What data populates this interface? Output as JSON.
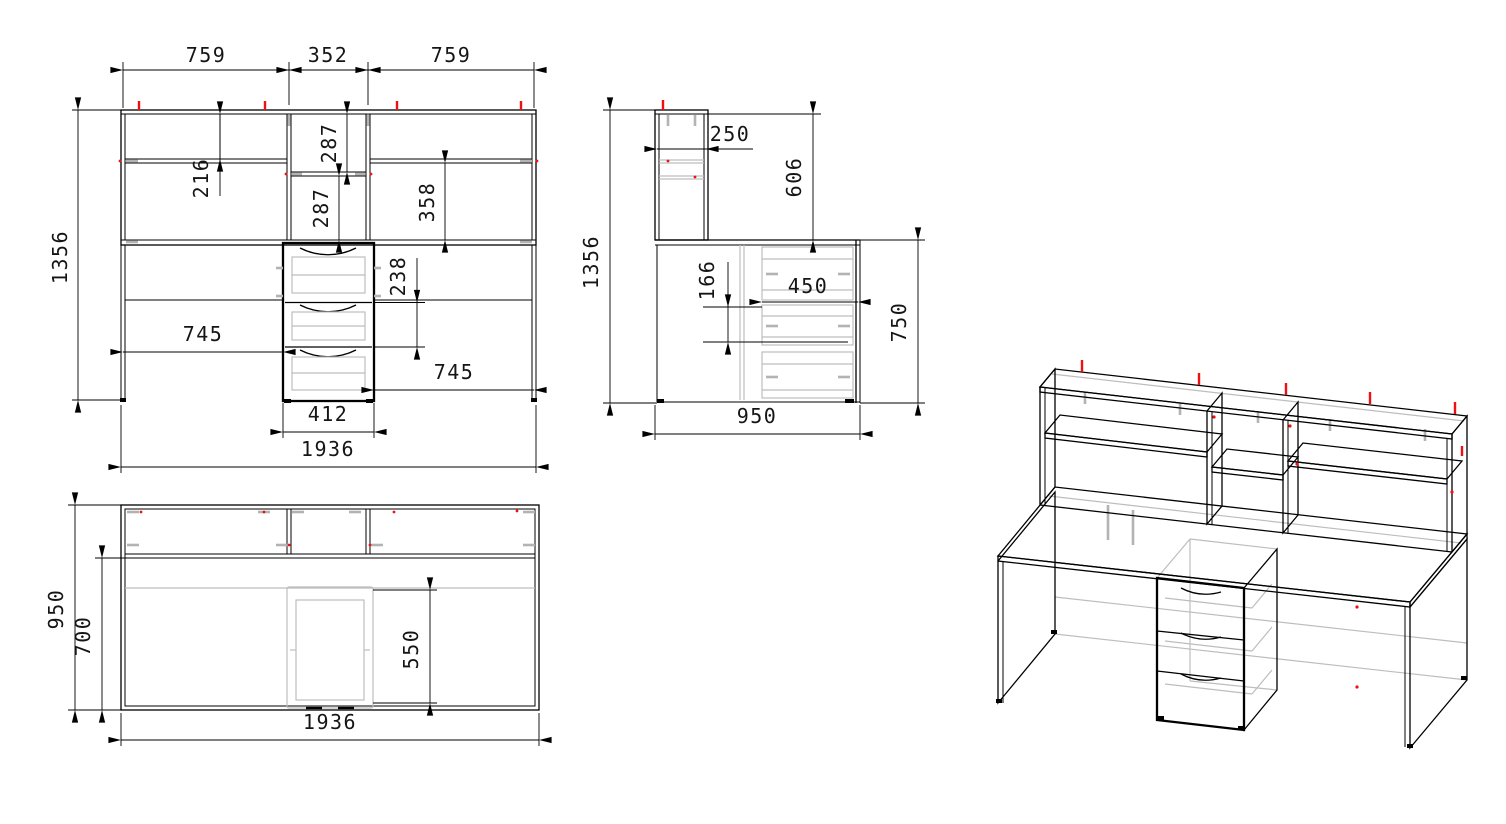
{
  "drawing": {
    "type": "furniture-cad-drawing",
    "colors": {
      "line": "#000000",
      "hidden": "#bdbdbd",
      "marker_red": "#ee1111",
      "dim_text": "#151515",
      "background": "#ffffff"
    },
    "front_view": {
      "top_left_width": "759",
      "top_mid_width": "352",
      "top_right_width": "759",
      "total_height": "1356",
      "left_shelf_drop": "216",
      "mid_shelf_upper": "287",
      "mid_shelf_lower": "287",
      "right_shelf_height": "358",
      "drawer_pitch": "238",
      "left_clear_width": "745",
      "right_clear_width": "745",
      "pedestal_width": "412",
      "total_width": "1936"
    },
    "side_view": {
      "hutch_depth": "250",
      "hutch_height": "606",
      "total_height": "1356",
      "drawer_gap": "166",
      "drawer_depth": "450",
      "desk_height": "750",
      "total_depth": "950"
    },
    "top_view": {
      "total_depth": "950",
      "front_depth": "700",
      "pedestal_depth": "550",
      "total_width": "1936"
    }
  }
}
